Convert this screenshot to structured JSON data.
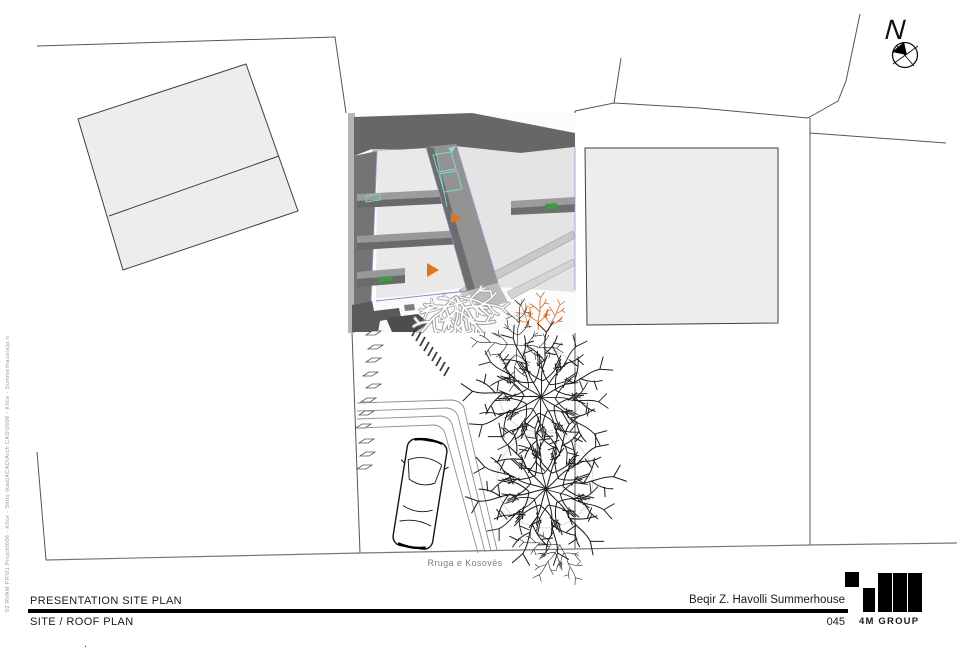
{
  "sheet": {
    "titleblock": {
      "presentation_label": "PRESENTATION SITE PLAN",
      "sheet_label": "SITE / ROOF PLAN",
      "project_name": "Beqir Z. Havolli Summerhouse",
      "sheet_number": "045",
      "company_name": "4M GROUP"
    },
    "plan": {
      "street_label": "Rruga e Kosovës",
      "north_label": "N"
    },
    "margin_note": "02 RVAM PR\\01 Projct0606 - Kllce - Shtiq (kad)ACAD\\Arch CAD\\0606 - Kllce - Summerhaus(a)p.n",
    "stray_mark": ".",
    "colors": {
      "paper": "#ffffff",
      "boundary_line": "#555555",
      "street_line": "#777777",
      "building_fill": "#ededed",
      "render_dark": "#676767",
      "render_mid": "#9a9a9a",
      "render_light": "#e8e8e8",
      "accent_orange": "#df761d",
      "accent_teal": "#7fd8c6",
      "accent_green": "#3f9b41",
      "accent_blue": "#9a9ad0"
    }
  }
}
